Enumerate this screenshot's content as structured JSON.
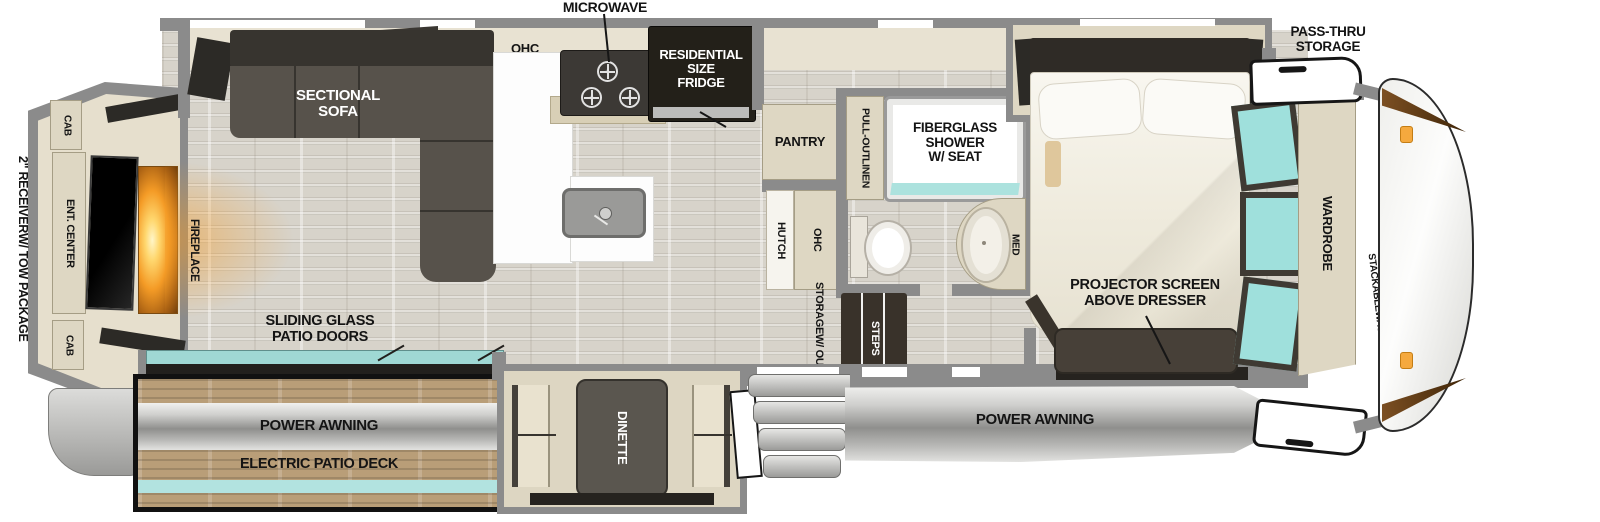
{
  "colors": {
    "wall_gray": "#8b8b8b",
    "floor_wood": "#d7d3ca",
    "cabinet_tan": "#ded7c3",
    "furniture_dark": "#474038",
    "glass_teal": "#9fe0dc",
    "awning_gray": "#b7b7b5",
    "deck_wood": "#b99e78",
    "fireplace_orange": "#f49b26",
    "outline_black": "#161616"
  },
  "exterior": {
    "receiver_label": [
      "2\" RECEIVER",
      "W/ TOW PACKAGE"
    ],
    "pass_thru_label": [
      "PASS-THRU",
      "STORAGE"
    ],
    "power_awning_front": "POWER AWNING",
    "patio": {
      "power_awning": "POWER AWNING",
      "deck_label": "ELECTRIC PATIO DECK"
    }
  },
  "living_room": {
    "sofa_label": [
      "SECTIONAL",
      "SOFA"
    ],
    "fireplace_label": "FIREPLACE",
    "ent_center_label": "ENT. CENTER",
    "cab_top_label": "CAB",
    "cab_bottom_label": "CAB",
    "patio_doors_label": [
      "SLIDING GLASS",
      "PATIO DOORS"
    ],
    "dinette_label": "DINETTE"
  },
  "kitchen": {
    "microwave_label": "MICROWAVE",
    "ohc_label": "OHC",
    "fridge_label": [
      "RESIDENTIAL",
      "SIZE",
      "FRIDGE"
    ],
    "pantry_label": "PANTRY",
    "hutch_label": "HUTCH",
    "hutch_ohc_label": "OHC",
    "storage_outlet_label": [
      "STORAGE",
      "W/ OUTLET"
    ],
    "steps_label": "STEPS"
  },
  "bathroom": {
    "shower_label": [
      "FIBERGLASS",
      "SHOWER",
      "W/ SEAT"
    ],
    "linen_label": [
      "PULL-OUT",
      "LINEN"
    ],
    "med_label": "MED"
  },
  "bedroom": {
    "projector_label": [
      "PROJECTOR SCREEN",
      "ABOVE DRESSER"
    ],
    "wardrobe_label": "WARDROBE",
    "washer_prep_label": [
      "STACKABLE",
      "WASHER/",
      "DRYER",
      "PREP"
    ]
  }
}
